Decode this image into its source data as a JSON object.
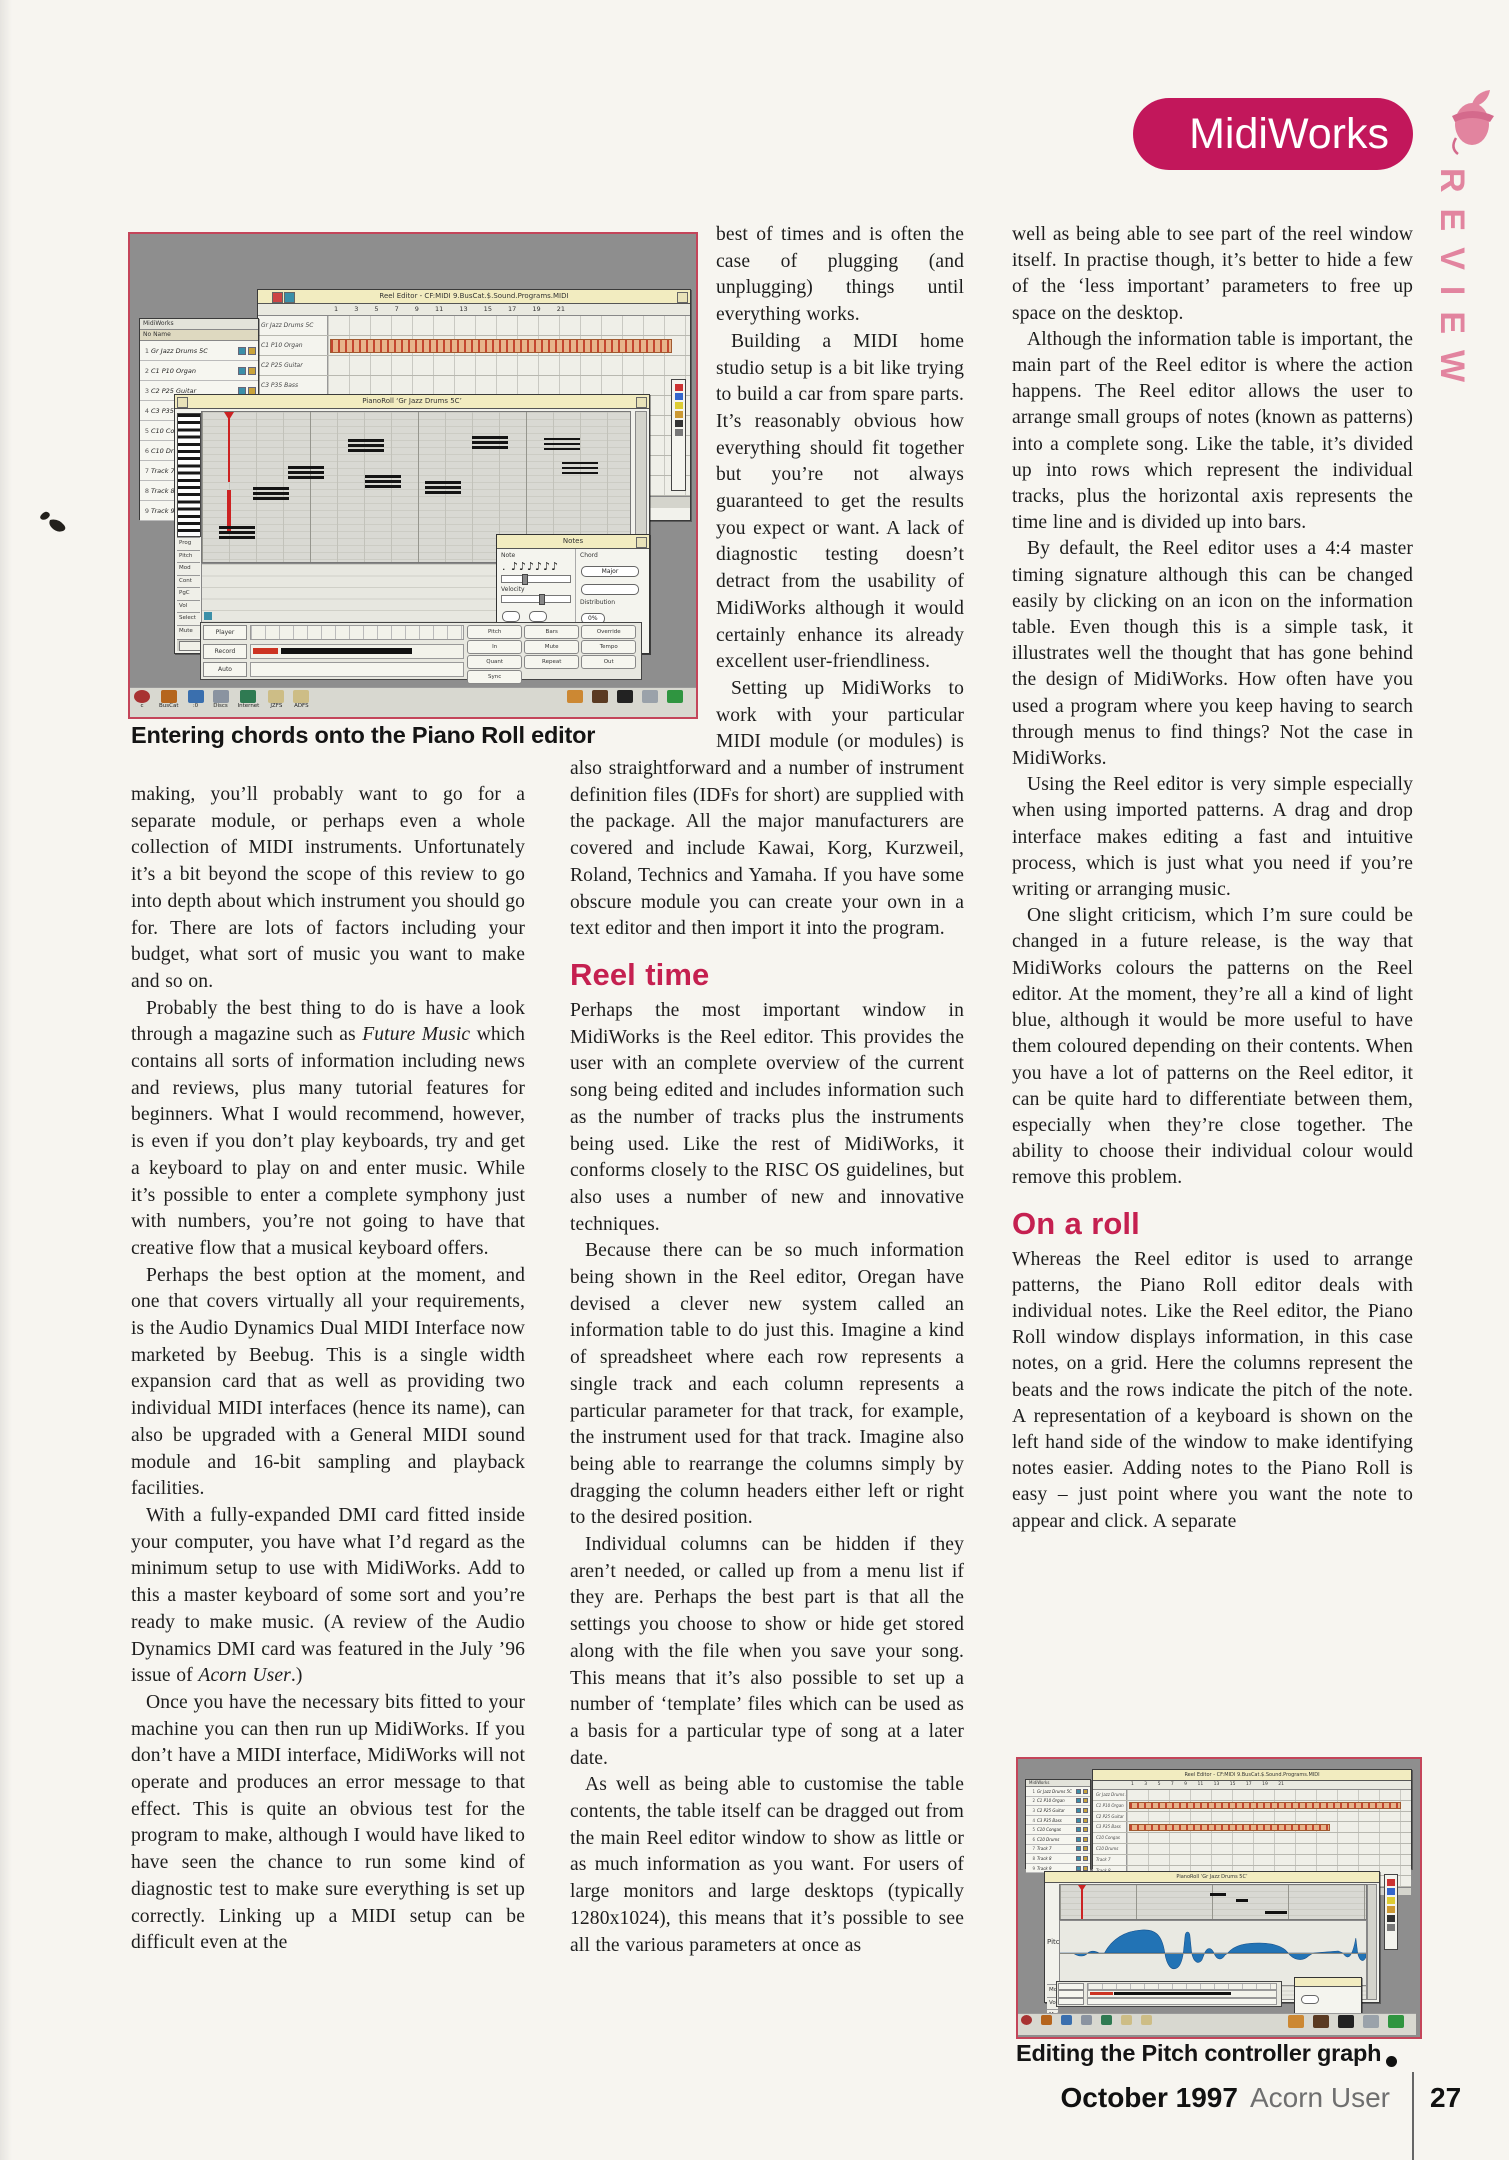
{
  "header": {
    "badge": "MidiWorks",
    "review": "REVIEW"
  },
  "columns": {
    "col1": [
      {
        "t": "p",
        "ind": false,
        "html": "making, you’ll probably want to go for a separate module, or perhaps even a whole collection of MIDI instruments. Unfortunately it’s a bit beyond the scope of this review to go into depth about which instrument you should go for. There are lots of factors including your budget, what sort of music you want to make and so on."
      },
      {
        "t": "p",
        "ind": true,
        "html": "Probably the best thing to do is have a look through a magazine such as <i>Future Music</i> which contains all sorts of information including news and reviews, plus many tutorial features for beginners. What I would recommend, however, is even if you don’t play keyboards, try and get a keyboard to play on and enter music. While it’s possible to enter a complete symphony just with numbers, you’re not going to have that creative flow that a musical keyboard offers."
      },
      {
        "t": "p",
        "ind": true,
        "html": "Perhaps the best option at the moment, and one that covers virtually all your requirements, is the Audio Dynamics Dual MIDI Interface now marketed by Beebug. This is a single width expansion card that as well as providing two individual MIDI interfaces (hence its name), can also be upgraded with a General MIDI sound module and 16-bit sampling and playback facilities."
      },
      {
        "t": "p",
        "ind": true,
        "html": "With a fully-expanded DMI card fitted inside your computer, you have what I’d regard as the minimum setup to use with MidiWorks. Add to this a master keyboard of some sort and you’re ready to make music. (A review of the Audio Dynamics DMI card was featured in the July ’96 issue of <i>Acorn User</i>.)"
      },
      {
        "t": "p",
        "ind": true,
        "html": "Once you have the necessary bits fitted to your machine you can then run up MidiWorks. If you don’t have a MIDI interface, MidiWorks will not operate and produces an error message to that effect. This is quite an obvious test for the program to make, although I would have liked to have seen the chance to run some kind of diagnostic test to make sure everything is set up correctly. Linking up a MIDI setup can be difficult even at the"
      }
    ],
    "col2": [
      {
        "t": "p",
        "ind": false,
        "html": "best of times and is often the case of plugging (and unplugging) things until everything works."
      },
      {
        "t": "p",
        "ind": true,
        "html": "Building a MIDI home studio setup is a bit like trying to build a car from spare parts. It’s reasonably obvious how everything should fit together but you’re not always guaranteed to get the results you expect or want. A lack of diagnostic testing doesn’t detract from the usability of MidiWorks although it would certainly enhance its already excellent user-friendliness."
      },
      {
        "t": "p",
        "ind": true,
        "html": "Setting up MidiWorks to work with your particular MIDI module (or modules) is also straightforward and a number of instrument definition files (IDFs for short) are supplied with the package. All the major manufacturers are covered and include Kawai, Korg, Kurzweil, Roland, Technics and Yamaha. If you have some obscure module you can create your own in a text editor and then import it into the program."
      },
      {
        "t": "h",
        "html": "Reel time"
      },
      {
        "t": "p",
        "ind": false,
        "html": "Perhaps the most important window in MidiWorks is the Reel editor. This provides the user with an complete overview of the current song being edited and includes information such as the number of tracks plus the instruments being used. Like the rest of MidiWorks, it conforms closely to the RISC OS guidelines, but also uses a number of new and innovative techniques."
      },
      {
        "t": "p",
        "ind": true,
        "html": "Because there can be so much information being shown in the Reel editor, Oregan have devised a clever new system called an information table to do just this. Imagine a kind of spreadsheet where each row represents a single track and each column represents a particular parameter for that track, for example, the instrument used for that track. Imagine also being able to rearrange the columns simply by dragging the column headers either left or right to the desired position."
      },
      {
        "t": "p",
        "ind": true,
        "html": "Individual columns can be hidden if they aren’t needed, or called up from a menu list if they are. Perhaps the best part is that all the settings you choose to show or hide get stored along with the file when you save your song. This means that it’s also possible to set up a number of ‘template’ files which can be used as a basis for a particular type of song at a later date."
      },
      {
        "t": "p",
        "ind": true,
        "html": "As well as being able to customise the table contents, the table itself can be dragged out from the main Reel editor window to show as little or as much information as you want. For users of large monitors and large desktops (typically 1280x1024), this means that it’s possible to see all the various parameters at once as"
      }
    ],
    "col3": [
      {
        "t": "p",
        "ind": false,
        "html": "well as being able to see part of the reel window itself. In practise though, it’s better to hide a few of the ‘less important’ parameters to free up space on the desktop."
      },
      {
        "t": "p",
        "ind": true,
        "html": "Although the information table is important, the main part of the Reel editor is where the action happens. The Reel editor allows the user to arrange small groups of notes (known as patterns) into a complete song. Like the table, it’s divided up into rows which represent the individual tracks, plus the horizontal axis represents the time line and is divided up into bars."
      },
      {
        "t": "p",
        "ind": true,
        "html": "By default, the Reel editor uses a 4:4 master timing signature although this can be changed easily by clicking on an icon on the information table. Even though this is a simple task, it illustrates well the thought that has gone behind the design of MidiWorks. How often have you used a program where you keep having to search through menus to find things? Not the case in MidiWorks."
      },
      {
        "t": "p",
        "ind": true,
        "html": "Using the Reel editor is very simple especially when using imported patterns. A drag and drop interface makes editing a fast and intuitive process, which is just what you need if you’re writing or arranging music."
      },
      {
        "t": "p",
        "ind": true,
        "html": "One slight criticism, which I’m sure could be changed in a future release, is the way that MidiWorks colours the patterns on the Reel editor. At the moment, they’re all a kind of light blue, although it would be more useful to have them coloured depending on their contents. When you have a lot of patterns on the Reel editor, it can be quite hard to differentiate between them, especially when they’re close together. The ability to choose their individual colour would remove this problem."
      },
      {
        "t": "h",
        "html": "On a roll"
      },
      {
        "t": "p",
        "ind": false,
        "html": "Whereas the Reel editor is used to arrange patterns, the Piano Roll editor deals with individual notes. Like the Reel editor, the Piano Roll window displays information, in this case notes, on a grid. Here the columns represent the beats and the rows indicate the pitch of the note. A representation of a keyboard is shown on the left hand side of the window to make identifying notes easier. Adding notes to the Piano Roll is easy – just point where you want the note to appear and click. A separate"
      }
    ]
  },
  "fig1": {
    "caption": "Entering chords onto the Piano Roll editor",
    "info_table_title": "MidiWorks",
    "info_table_header": "No  Name",
    "tracks": [
      "Gr Jazz Drums 5C",
      "C1 P10 Organ",
      "C2 P25 Guitar",
      "C3 P35 Bass",
      "C10 Congas",
      "C10 Drums",
      "Track 7",
      "Track 8",
      "Track 9"
    ],
    "strips": [
      [
        1,
        94
      ],
      [
        4,
        80
      ]
    ],
    "reel_title": "Reel Editor - CF:MIDI 9.BusCat.$.Sound.Programs.MIDI",
    "bar_numbers": "1 3 5 7 9 11 13 15 17 19 21",
    "piano_title": "PianoRoll  ‘Gr Jazz Drums 5C’",
    "chords": [
      [
        4,
        76
      ],
      [
        12,
        50
      ],
      [
        20,
        36
      ],
      [
        34,
        18
      ],
      [
        38,
        42
      ],
      [
        52,
        46
      ],
      [
        63,
        16
      ],
      [
        80,
        17
      ],
      [
        84,
        33
      ]
    ],
    "ctl_labels": [
      "Prog",
      "Pitch",
      "Mod",
      "Cont",
      "PgC",
      "Vol",
      "Select",
      "Mute"
    ],
    "notes_dialog": {
      "title": "Notes",
      "note_label": "Note",
      "glyphs": ". ♪♪♪♪♪♪",
      "chord_label": "Chord",
      "chord_type": "Major",
      "dist_label": "Distribution",
      "dist_value": "0%",
      "velocity_label": "Velocity"
    },
    "transport_rows": [
      "Player",
      "Record",
      "Auto"
    ],
    "transport_cells": [
      "Pitch",
      "Bars",
      "Override",
      "In",
      "Mute",
      "Tempo",
      "Quant",
      "Repeat",
      "Out",
      "Sync"
    ],
    "icons": [
      {
        "l": "BusCat",
        "c": "#b5651d"
      },
      {
        "l": ":0",
        "c": "#3a6fae"
      },
      {
        "l": "Discs",
        "c": "#8a93a0"
      },
      {
        "l": "Internet",
        "c": "#2f7a52"
      },
      {
        "l": "JZFS",
        "c": "#cdbd86"
      },
      {
        "l": "ADFS",
        "c": "#cdbd86"
      }
    ],
    "right_icons": [
      {
        "c": "#cc8833"
      },
      {
        "c": "#5a3a22"
      },
      {
        "c": "#222222"
      },
      {
        "c": "#9aa2aa"
      },
      {
        "c": "#2f9540"
      }
    ],
    "tool_marks": [
      {
        "c": "#cc3333"
      },
      {
        "c": "#3366cc"
      },
      {
        "c": "#ddcc33"
      },
      {
        "c": "#cc9933"
      },
      {
        "c": "#333333"
      },
      {
        "c": "#777777"
      }
    ]
  },
  "fig2": {
    "caption": "Editing the Pitch controller graph",
    "reel_title": "Reel Editor - CF:MIDI 9.BusCat.$.Sound.Programs.MIDI",
    "ctl_title": "PianoRoll  ‘Gr Jazz Drums 5C’",
    "strips": [
      [
        1,
        95
      ],
      [
        3,
        70
      ]
    ],
    "pitch_label": "Pitch",
    "lane_labels": [
      "Mod",
      "Vol",
      "Mute"
    ],
    "pitch_wave_path": "M0 32 L14 32 C20 36 26 36 30 32 C34 29 38 30 42 32 L48 32 C56 18 70 10 88 9 C102 8 110 13 113 32 C115 44 120 50 126 47 C130 45 132 38 133 32 L135 14 C136 10 139 10 140 14 L142 32 C144 41 149 44 153 39 L156 32 C159 26 163 26 166 32 C169 39 174 40 178 34 L181 32 C188 24 200 22 215 22 C228 22 238 25 243 29 L246 32 C252 39 261 41 268 35 L273 32 L300 30 L305 32 C308 36 311 38 314 33 C317 28 318 22 319 17 L321 32 C323 40 327 42 330 36 L330 32 Z"
  },
  "footer": {
    "issue": "October 1997",
    "magazine": "Acorn User",
    "page": "27"
  }
}
